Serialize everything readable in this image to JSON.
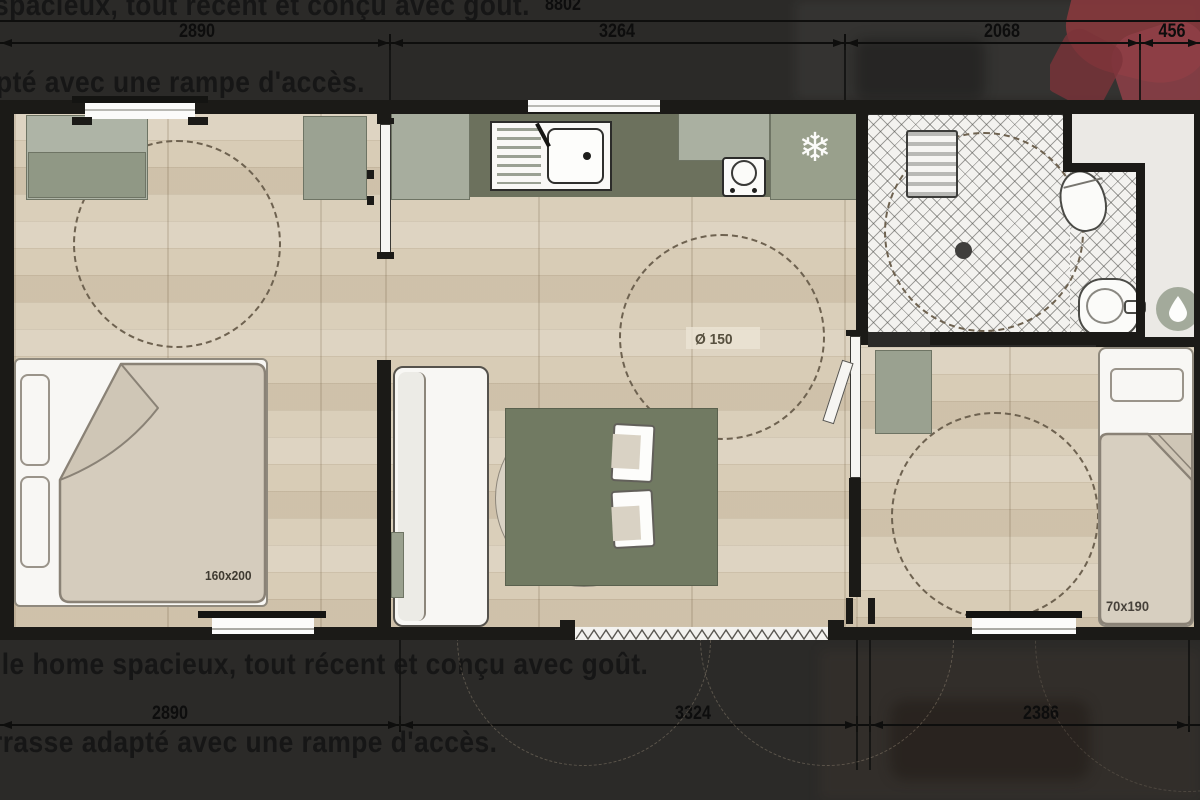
{
  "background_text": {
    "top_line_1": "spacieux, tout récent et conçu avec goût.",
    "top_line_2": "pté avec une rampe d'accès.",
    "bottom_line_1": "ile home spacieux, tout récent et conçu avec goût.",
    "bottom_line_2": "rrasse adapté avec une rampe d'accès."
  },
  "dimensions_mm": {
    "overall_top": "8802",
    "top": [
      "2890",
      "3264",
      "2068",
      "456"
    ],
    "bottom": [
      "2890",
      "3324",
      "2386"
    ]
  },
  "room_labels": {
    "clearance_circle": "Ø 150",
    "double_bed": "160x200",
    "single_bed": "70x190"
  },
  "glyphs": {
    "snowflake": "❄"
  },
  "icons": {
    "fridge": "snowflake-icon",
    "water_heater": "water-drop-icon"
  },
  "colors": {
    "overlay_bg": "#2b2a28",
    "wood_floor": "#d8ccb6",
    "cabinet_sage": "#a0a795",
    "counter_olive": "#6c715d",
    "table_olive": "#717a62",
    "bed_linen": "#d5ccbd",
    "wall": "#1b1a17",
    "logo_red": "#8c3a3e"
  }
}
